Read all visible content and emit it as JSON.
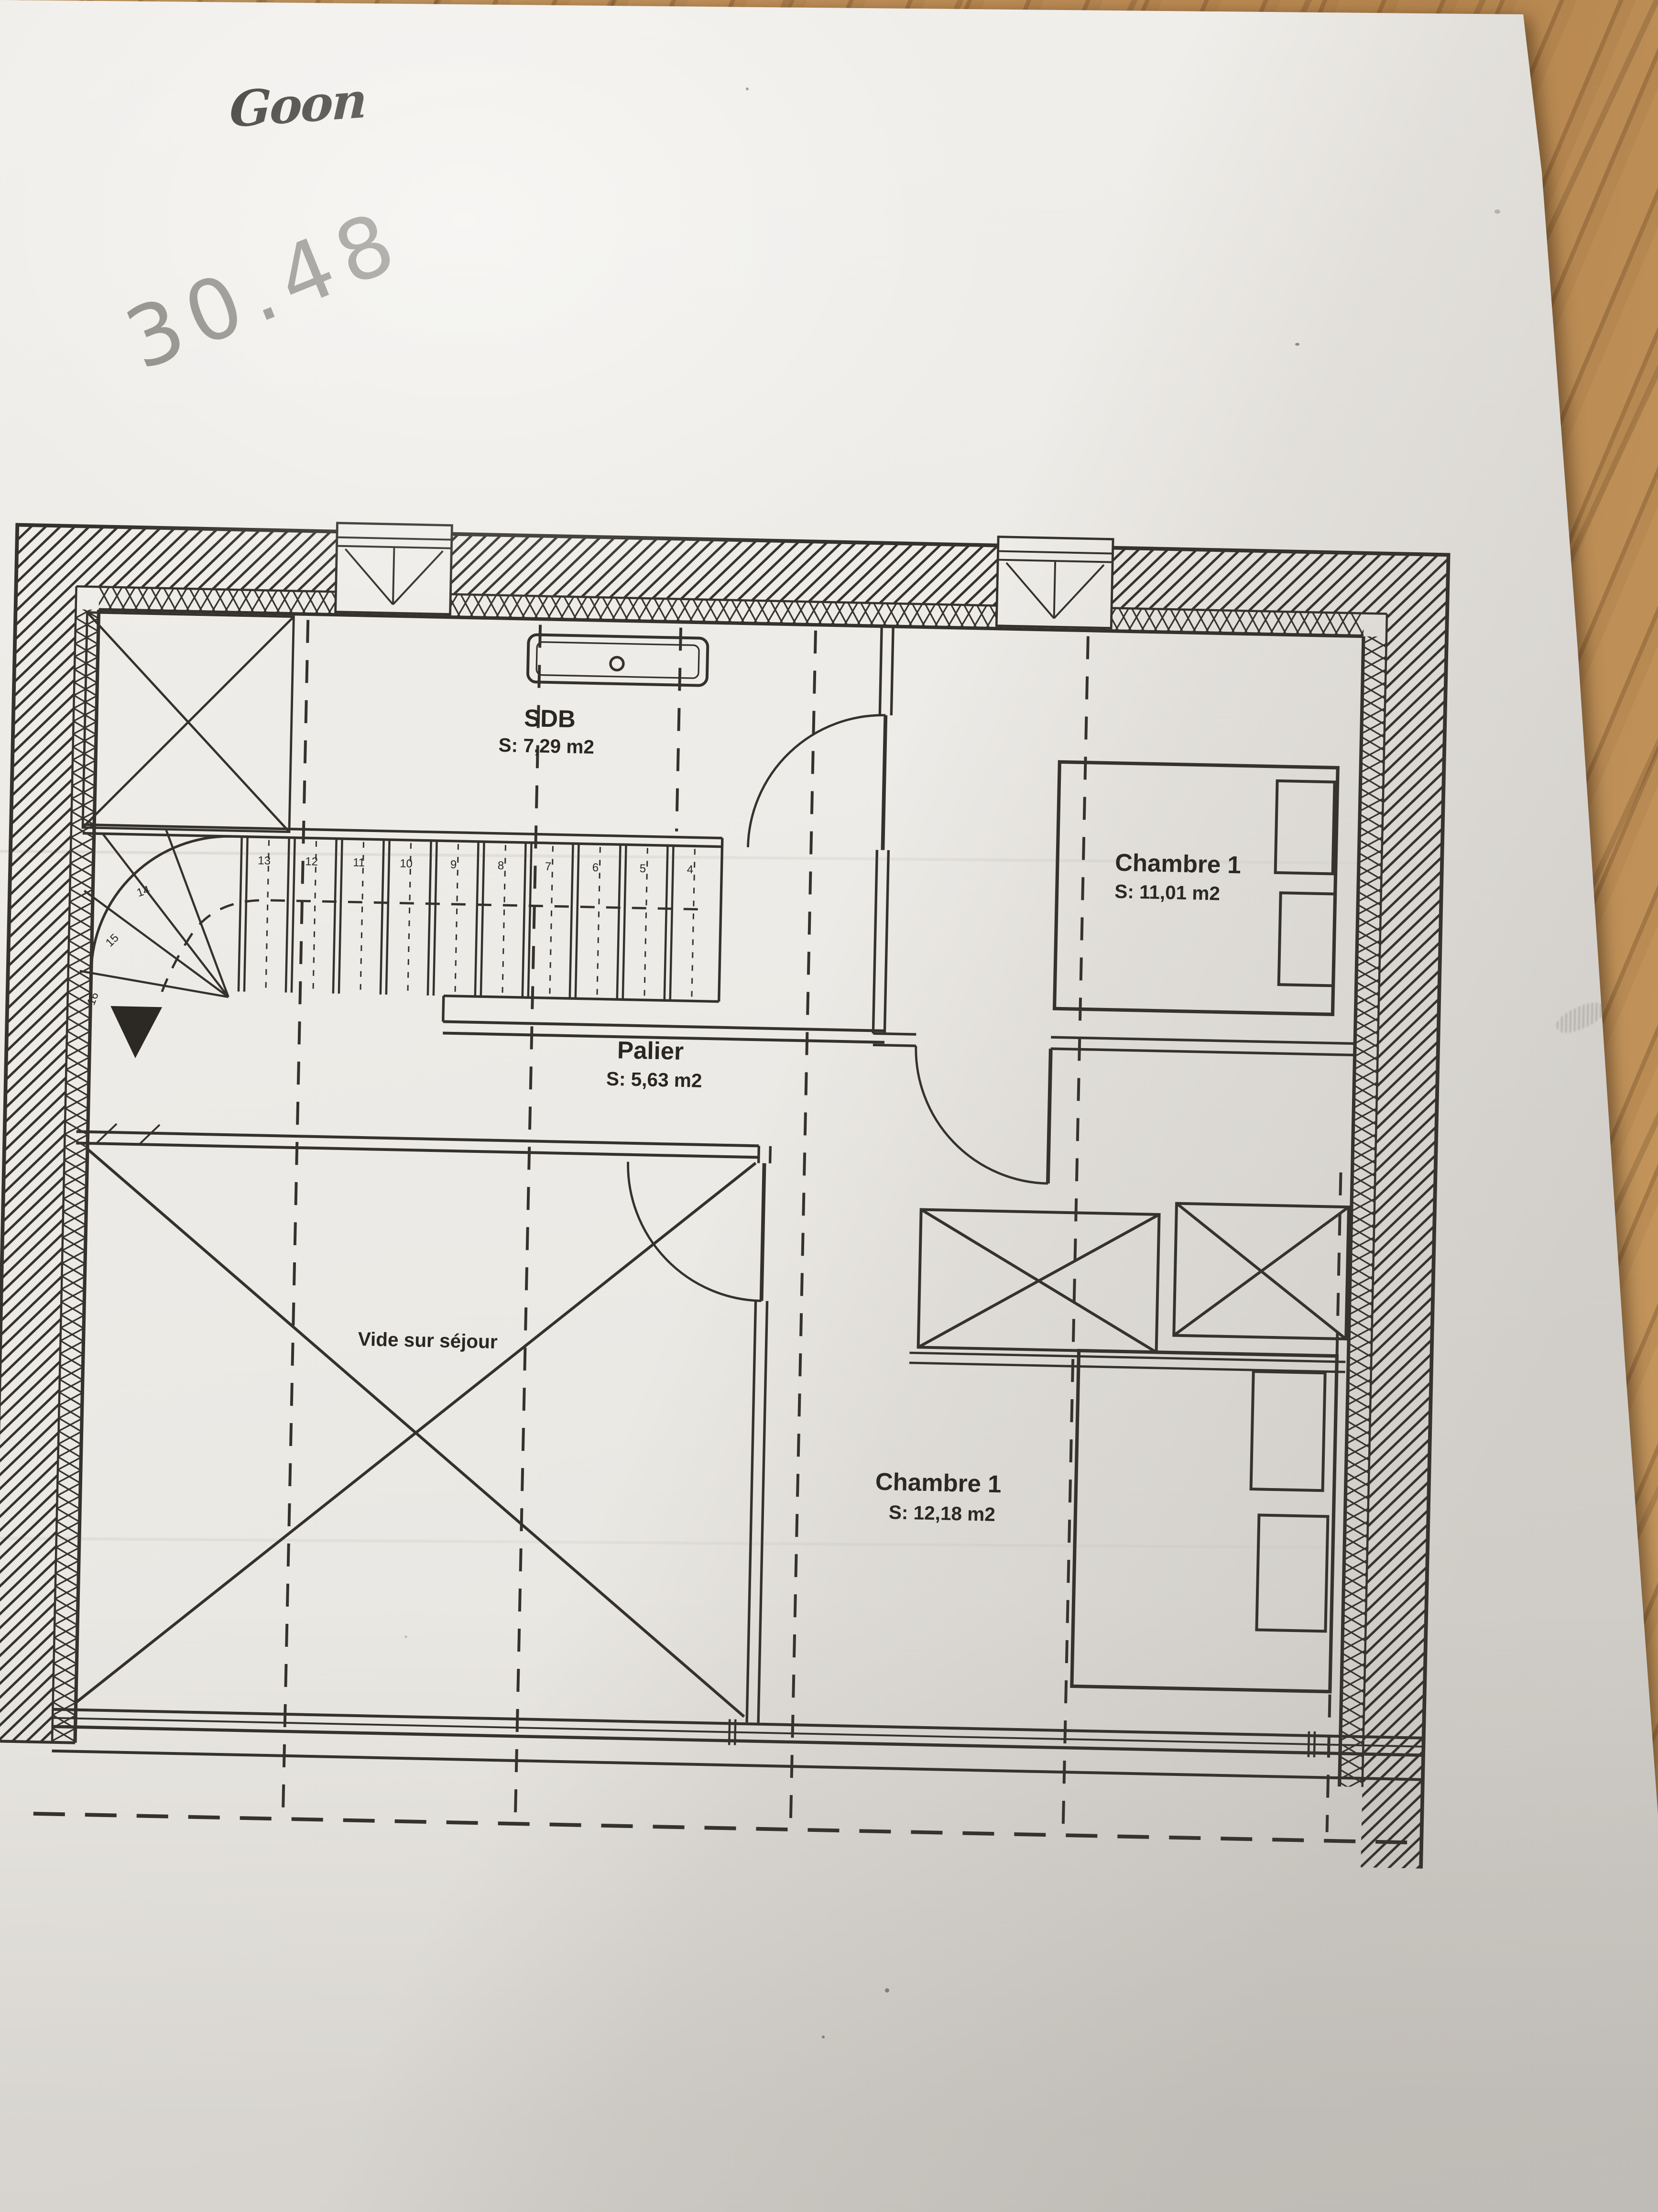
{
  "photo": {
    "surface": "wood-table",
    "colors": {
      "wood": "#c2915a",
      "paper": "#edebe7",
      "ink": "#35322d",
      "pencil": "#68655f"
    }
  },
  "handwritten": {
    "name": "Goon",
    "number": "30.48"
  },
  "floorplan": {
    "rooms": [
      {
        "name": "SDB",
        "area": "S: 7,29 m2"
      },
      {
        "name": "Chambre 1",
        "area": "S: 11,01 m2"
      },
      {
        "name": "Palier",
        "area": "S: 5,63 m2"
      },
      {
        "name": "Vide sur séjour",
        "area": ""
      },
      {
        "name": "Chambre 1",
        "area": "S: 12,18 m2"
      }
    ],
    "stairs": {
      "tread_numbers": [
        "13",
        "12",
        "11",
        "10",
        "9",
        "8",
        "7",
        "6",
        "5",
        "4"
      ],
      "winder_numbers": [
        "14",
        "15",
        "16"
      ]
    }
  }
}
